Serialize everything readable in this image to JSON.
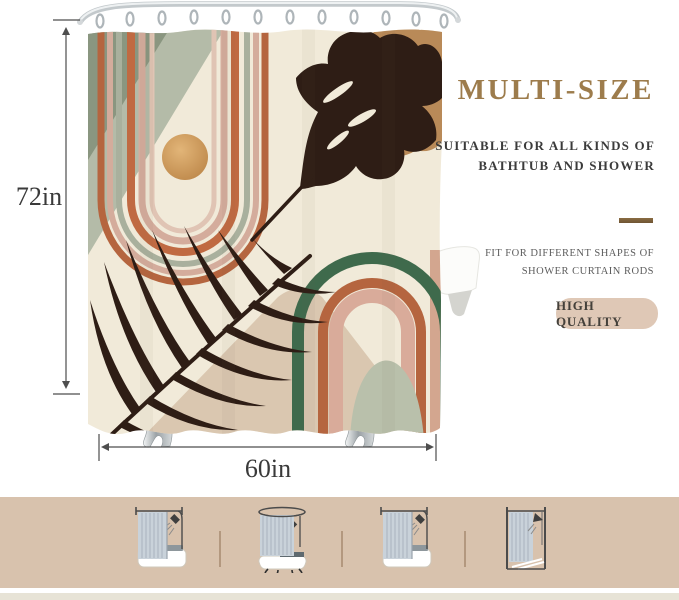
{
  "product_diagram": {
    "height_label": "72in",
    "width_label": "60in"
  },
  "info_panel": {
    "title": "MULTI-SIZE",
    "subtitle_lines": [
      "SUITABLE FOR ALL KINDS OF",
      "BATHTUB AND SHOWER"
    ],
    "note_lines": [
      "FIT FOR DIFFERENT SHAPES OF",
      "SHOWER CURTAIN RODS"
    ],
    "badge_label": "HIGH QUALITY"
  },
  "footer": {
    "icon_names": [
      "straight-rod-bathtub-icon",
      "oval-rod-clawfoot-tub-icon",
      "straight-rod-bathtub-icon",
      "shower-stall-icon"
    ]
  },
  "colors": {
    "accent_gold": "#9d7c4c",
    "text_dark": "#3a3a3a",
    "text_gray": "#5d5d5d",
    "badge_bg": "#dfc8b6",
    "divider_gold": "#8a6c42",
    "footer_bg": "#d8c2ad",
    "footer_divider": "#b3987f",
    "curtain_cream": "#f1ead9",
    "terracotta": "#b5653f",
    "dusty_pink": "#d4ac9c",
    "sage": "#a9b09d",
    "dark_green": "#3f6a4c",
    "leaf_brown": "#2e1d15",
    "sun_gold": "#c9955a",
    "tan_leaf": "#b98a58"
  }
}
